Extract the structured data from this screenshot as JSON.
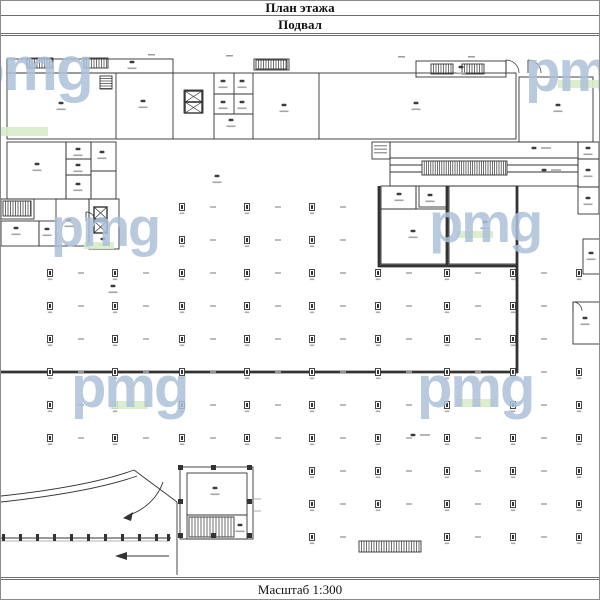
{
  "header": {
    "title": "План этажа",
    "subtitle": "Подвал"
  },
  "footer": {
    "scale_label": "Масштаб 1:300"
  },
  "watermark": {
    "text": "pmg",
    "letter_color": "#aec1d9",
    "bar_color": "#d9ecca",
    "instances": [
      {
        "x": -34,
        "y": 40,
        "size": 62,
        "bar": {
          "x": 0,
          "y": 128,
          "w": 47,
          "h": 9
        }
      },
      {
        "x": 524,
        "y": 44,
        "size": 58,
        "bar": {
          "x": 557,
          "y": 81,
          "w": 43,
          "h": 8
        }
      },
      {
        "x": 50,
        "y": 202,
        "size": 54,
        "bar": {
          "x": 83,
          "y": 243,
          "w": 30,
          "h": 7
        }
      },
      {
        "x": 428,
        "y": 196,
        "size": 56,
        "bar": {
          "x": 456,
          "y": 232,
          "w": 36,
          "h": 7
        }
      },
      {
        "x": 70,
        "y": 360,
        "size": 58,
        "bar": {
          "x": 109,
          "y": 402,
          "w": 38,
          "h": 8
        }
      },
      {
        "x": 416,
        "y": 360,
        "size": 58,
        "bar": {
          "x": 455,
          "y": 400,
          "w": 37,
          "h": 8
        }
      }
    ]
  },
  "plan": {
    "ink": "#333333",
    "light": "#9b9b9b",
    "thin_rects": [
      {
        "n": "top-corridor",
        "x": 6,
        "y": 60,
        "w": 166,
        "h": 14
      },
      {
        "n": "window-block",
        "x": 253,
        "y": 60,
        "w": 35,
        "h": 11
      },
      {
        "n": "window-block",
        "x": 415,
        "y": 62,
        "w": 90,
        "h": 16
      },
      {
        "n": "top-rooms-band",
        "x": 6,
        "y": 74,
        "w": 509,
        "h": 66
      },
      {
        "n": "top-right-room",
        "x": 518,
        "y": 78,
        "w": 74,
        "h": 65
      },
      {
        "n": "room",
        "x": 6,
        "y": 143,
        "w": 59,
        "h": 57
      },
      {
        "n": "rooms-strip",
        "x": 65,
        "y": 143,
        "w": 25,
        "h": 57
      },
      {
        "n": "rooms-strip",
        "x": 90,
        "y": 143,
        "w": 25,
        "h": 57
      },
      {
        "n": "stair-enclosure",
        "x": 0,
        "y": 200,
        "w": 33,
        "h": 20
      },
      {
        "n": "room",
        "x": 0,
        "y": 222,
        "w": 38,
        "h": 25
      },
      {
        "n": "room",
        "x": 38,
        "y": 222,
        "w": 17,
        "h": 25
      },
      {
        "n": "room",
        "x": 55,
        "y": 200,
        "w": 33,
        "h": 47
      },
      {
        "n": "elevator-tower",
        "x": 88,
        "y": 200,
        "w": 30,
        "h": 50
      },
      {
        "n": "label-box",
        "x": 371,
        "y": 143,
        "w": 18,
        "h": 17
      },
      {
        "n": "ramp-corridor",
        "x": 389,
        "y": 143,
        "w": 188,
        "h": 16
      },
      {
        "n": "ramp-corridor",
        "x": 389,
        "y": 159,
        "w": 188,
        "h": 28
      },
      {
        "n": "right-rooms",
        "x": 577,
        "y": 143,
        "w": 21,
        "h": 72
      },
      {
        "n": "room",
        "x": 380,
        "y": 187,
        "w": 35,
        "h": 23
      },
      {
        "n": "room",
        "x": 418,
        "y": 187,
        "w": 28,
        "h": 21
      },
      {
        "n": "room",
        "x": 380,
        "y": 210,
        "w": 66,
        "h": 55
      },
      {
        "n": "room",
        "x": 448,
        "y": 187,
        "w": 68,
        "h": 78
      },
      {
        "n": "room",
        "x": 582,
        "y": 240,
        "w": 18,
        "h": 35
      },
      {
        "n": "room",
        "x": 572,
        "y": 303,
        "w": 28,
        "h": 42
      },
      {
        "n": "stair-room",
        "x": 179,
        "y": 468,
        "w": 73,
        "h": 72
      },
      {
        "n": "room",
        "x": 186,
        "y": 474,
        "w": 60,
        "h": 42
      },
      {
        "n": "stair-zone",
        "x": 186,
        "y": 516,
        "w": 60,
        "h": 24
      },
      {
        "n": "elevator-block",
        "x": 183,
        "y": 91,
        "w": 19,
        "h": 23
      }
    ],
    "thin_lines": [
      {
        "x1": 115,
        "y1": 74,
        "x2": 115,
        "y2": 140
      },
      {
        "x1": 172,
        "y1": 74,
        "x2": 172,
        "y2": 140
      },
      {
        "x1": 213,
        "y1": 74,
        "x2": 213,
        "y2": 140
      },
      {
        "x1": 252,
        "y1": 74,
        "x2": 252,
        "y2": 140
      },
      {
        "x1": 318,
        "y1": 74,
        "x2": 318,
        "y2": 140
      },
      {
        "x1": 233,
        "y1": 74,
        "x2": 233,
        "y2": 115
      },
      {
        "x1": 213,
        "y1": 95,
        "x2": 252,
        "y2": 95
      },
      {
        "x1": 213,
        "y1": 115,
        "x2": 252,
        "y2": 115
      },
      {
        "x1": 65,
        "y1": 160,
        "x2": 90,
        "y2": 160
      },
      {
        "x1": 65,
        "y1": 176,
        "x2": 90,
        "y2": 176
      },
      {
        "x1": 90,
        "y1": 172,
        "x2": 115,
        "y2": 172
      },
      {
        "x1": 577,
        "y1": 160,
        "x2": 598,
        "y2": 160
      },
      {
        "x1": 577,
        "y1": 188,
        "x2": 598,
        "y2": 188
      },
      {
        "x1": 389,
        "y1": 166,
        "x2": 421,
        "y2": 166
      },
      {
        "x1": 506,
        "y1": 166,
        "x2": 577,
        "y2": 166
      },
      {
        "x1": 389,
        "y1": 173,
        "x2": 421,
        "y2": 173
      },
      {
        "x1": 506,
        "y1": 173,
        "x2": 577,
        "y2": 173
      },
      {
        "x1": 415,
        "y1": 187,
        "x2": 415,
        "y2": 210
      },
      {
        "x1": 0,
        "y1": 539,
        "x2": 170,
        "y2": 539
      },
      {
        "x1": 176,
        "y1": 503,
        "x2": 176,
        "y2": 576
      }
    ],
    "thick_lines": [
      {
        "x1": 378,
        "y1": 187,
        "x2": 378,
        "y2": 268
      },
      {
        "x1": 446,
        "y1": 187,
        "x2": 446,
        "y2": 268
      },
      {
        "x1": 516,
        "y1": 187,
        "x2": 516,
        "y2": 374
      },
      {
        "x1": 377,
        "y1": 267,
        "x2": 517,
        "y2": 267
      },
      {
        "x1": 0,
        "y1": 373,
        "x2": 517,
        "y2": 373
      }
    ],
    "light_lines": [
      {
        "x1": 0,
        "y1": 542,
        "x2": 168,
        "y2": 542
      },
      {
        "x1": 252,
        "y1": 500,
        "x2": 260,
        "y2": 500
      },
      {
        "x1": 252,
        "y1": 512,
        "x2": 260,
        "y2": 512
      }
    ],
    "light_marks": [
      {
        "x": 373,
        "y": 146,
        "w": 13,
        "h": 1.4
      },
      {
        "x": 373,
        "y": 149.5,
        "w": 13,
        "h": 1.4
      },
      {
        "x": 373,
        "y": 153,
        "w": 13,
        "h": 1.4
      },
      {
        "x": 147,
        "y": 55,
        "w": 7,
        "h": 1.5
      },
      {
        "x": 225,
        "y": 56,
        "w": 7,
        "h": 1.5
      },
      {
        "x": 397,
        "y": 57,
        "w": 7,
        "h": 1.5
      },
      {
        "x": 467,
        "y": 57,
        "w": 7,
        "h": 1.5
      }
    ],
    "hatches": [
      {
        "n": "window-hatch",
        "x": 26,
        "y": 59,
        "w": 26,
        "h": 10,
        "dir": "v",
        "step": 2.5
      },
      {
        "n": "window-hatch",
        "x": 83,
        "y": 59,
        "w": 24,
        "h": 10,
        "dir": "v",
        "step": 2.5
      },
      {
        "n": "window-hatch",
        "x": 255,
        "y": 61,
        "w": 31,
        "h": 9,
        "dir": "v",
        "step": 2.5
      },
      {
        "n": "window-hatch",
        "x": 430,
        "y": 65,
        "w": 22,
        "h": 10,
        "dir": "v",
        "step": 2.5
      },
      {
        "n": "window-hatch",
        "x": 461,
        "y": 65,
        "w": 22,
        "h": 10,
        "dir": "v",
        "step": 2.5
      },
      {
        "n": "stair-hatch",
        "x": 99,
        "y": 77,
        "w": 12,
        "h": 13,
        "dir": "h",
        "step": 2.5
      },
      {
        "n": "stair-hatch",
        "x": 2,
        "y": 202,
        "w": 28,
        "h": 15,
        "dir": "v",
        "step": 2.5
      },
      {
        "n": "ramp-hatch",
        "x": 421,
        "y": 162,
        "w": 85,
        "h": 14,
        "dir": "v",
        "step": 2.2
      },
      {
        "n": "stair-hatch",
        "x": 188,
        "y": 518,
        "w": 45,
        "h": 20,
        "dir": "v",
        "step": 3
      },
      {
        "n": "ramp-hatch",
        "x": 358,
        "y": 542,
        "w": 62,
        "h": 11,
        "dir": "v",
        "step": 2.5
      }
    ],
    "x_boxes": [
      {
        "x": 93,
        "y": 208,
        "w": 13,
        "h": 12
      },
      {
        "x": 93,
        "y": 222,
        "w": 13,
        "h": 12
      },
      {
        "x": 184,
        "y": 92,
        "w": 17,
        "h": 11
      },
      {
        "x": 184,
        "y": 103,
        "w": 17,
        "h": 11
      }
    ],
    "door_arcs": [
      {
        "cx": 505,
        "cy": 74,
        "r": 13
      },
      {
        "cx": 527,
        "cy": 74,
        "r": 13
      },
      {
        "cx": 85,
        "cy": 222,
        "r": 9
      },
      {
        "cx": 572,
        "cy": 312,
        "r": 9
      }
    ],
    "posts": [
      {
        "x": 177,
        "y": 466,
        "w": 5,
        "h": 5
      },
      {
        "x": 246,
        "y": 466,
        "w": 5,
        "h": 5
      },
      {
        "x": 177,
        "y": 534,
        "w": 5,
        "h": 5
      },
      {
        "x": 246,
        "y": 534,
        "w": 5,
        "h": 5
      },
      {
        "x": 210,
        "y": 466,
        "w": 5,
        "h": 5
      },
      {
        "x": 210,
        "y": 534,
        "w": 5,
        "h": 5
      },
      {
        "x": 177,
        "y": 500,
        "w": 5,
        "h": 5
      },
      {
        "x": 246,
        "y": 500,
        "w": 5,
        "h": 5
      },
      {
        "x": 1,
        "y": 535,
        "w": 3,
        "h": 7
      },
      {
        "x": 18,
        "y": 535,
        "w": 3,
        "h": 7
      },
      {
        "x": 35,
        "y": 535,
        "w": 3,
        "h": 7
      },
      {
        "x": 52,
        "y": 535,
        "w": 3,
        "h": 7
      },
      {
        "x": 69,
        "y": 535,
        "w": 3,
        "h": 7
      },
      {
        "x": 86,
        "y": 535,
        "w": 3,
        "h": 7
      },
      {
        "x": 103,
        "y": 535,
        "w": 3,
        "h": 7
      },
      {
        "x": 120,
        "y": 535,
        "w": 3,
        "h": 7
      },
      {
        "x": 137,
        "y": 535,
        "w": 3,
        "h": 7
      },
      {
        "x": 154,
        "y": 535,
        "w": 3,
        "h": 7
      },
      {
        "x": 166,
        "y": 535,
        "w": 3,
        "h": 7
      }
    ],
    "paths": [
      {
        "n": "ramp-curve",
        "d": "M 0 497 C 55 491 100 483 133 471"
      },
      {
        "n": "ramp-curve",
        "d": "M 0 503 C 55 497 102 489 136 477"
      },
      {
        "n": "ramp-wall",
        "d": "M 133 471 L 176 503"
      },
      {
        "n": "direction-arrow",
        "d": "M 162 483 C 156 500 143 511 126 517"
      },
      {
        "n": "direction-arrow",
        "d": "M 168 557 L 124 557"
      }
    ],
    "arrow_heads": [
      {
        "points": "122,519 132,513 130,522"
      },
      {
        "points": "114,557 126,553 126,561"
      }
    ],
    "room_marks": [
      {
        "x": 60,
        "y": 104
      },
      {
        "x": 142,
        "y": 102
      },
      {
        "x": 222,
        "y": 82
      },
      {
        "x": 241,
        "y": 82
      },
      {
        "x": 222,
        "y": 103
      },
      {
        "x": 241,
        "y": 103
      },
      {
        "x": 230,
        "y": 121
      },
      {
        "x": 283,
        "y": 106
      },
      {
        "x": 415,
        "y": 104
      },
      {
        "x": 557,
        "y": 106
      },
      {
        "x": 131,
        "y": 63
      },
      {
        "x": 460,
        "y": 68
      },
      {
        "x": 36,
        "y": 165
      },
      {
        "x": 77,
        "y": 150
      },
      {
        "x": 77,
        "y": 166
      },
      {
        "x": 77,
        "y": 185
      },
      {
        "x": 101,
        "y": 153
      },
      {
        "x": 68,
        "y": 221
      },
      {
        "x": 15,
        "y": 229
      },
      {
        "x": 46,
        "y": 230
      },
      {
        "x": 102,
        "y": 240
      },
      {
        "x": 533,
        "y": 149,
        "side": "r"
      },
      {
        "x": 543,
        "y": 171,
        "side": "r"
      },
      {
        "x": 398,
        "y": 195
      },
      {
        "x": 429,
        "y": 196
      },
      {
        "x": 412,
        "y": 232
      },
      {
        "x": 484,
        "y": 223
      },
      {
        "x": 587,
        "y": 149
      },
      {
        "x": 587,
        "y": 171
      },
      {
        "x": 587,
        "y": 199
      },
      {
        "x": 590,
        "y": 254
      },
      {
        "x": 584,
        "y": 319
      },
      {
        "x": 214,
        "y": 489
      },
      {
        "x": 239,
        "y": 526
      },
      {
        "x": 216,
        "y": 177
      },
      {
        "x": 112,
        "y": 287
      },
      {
        "x": 412,
        "y": 436,
        "side": "r"
      }
    ],
    "grid": {
      "xs": [
        49,
        114,
        181,
        246,
        311,
        377,
        446,
        512,
        578
      ],
      "rows": [
        {
          "y": 208,
          "cols": [
            2,
            3,
            4
          ]
        },
        {
          "y": 241,
          "cols": [
            2,
            3,
            4
          ]
        },
        {
          "y": 274,
          "cols": [
            0,
            1,
            2,
            3,
            4,
            5,
            6,
            7,
            8
          ]
        },
        {
          "y": 307,
          "cols": [
            0,
            1,
            2,
            3,
            4,
            5,
            6,
            7
          ]
        },
        {
          "y": 340,
          "cols": [
            0,
            1,
            2,
            3,
            4,
            5,
            6,
            7
          ]
        },
        {
          "y": 373,
          "cols": [
            0,
            1,
            2,
            3,
            4,
            5,
            6,
            7,
            8
          ]
        },
        {
          "y": 406,
          "cols": [
            0,
            1,
            2,
            3,
            4,
            5,
            6,
            7,
            8
          ]
        },
        {
          "y": 439,
          "cols": [
            0,
            1,
            2,
            3,
            4,
            5,
            6,
            7,
            8
          ]
        },
        {
          "y": 472,
          "cols": [
            4,
            5,
            6,
            7,
            8
          ]
        },
        {
          "y": 505,
          "cols": [
            4,
            5,
            6,
            7,
            8
          ]
        },
        {
          "y": 538,
          "cols": [
            4,
            6,
            7,
            8
          ]
        }
      ]
    }
  }
}
